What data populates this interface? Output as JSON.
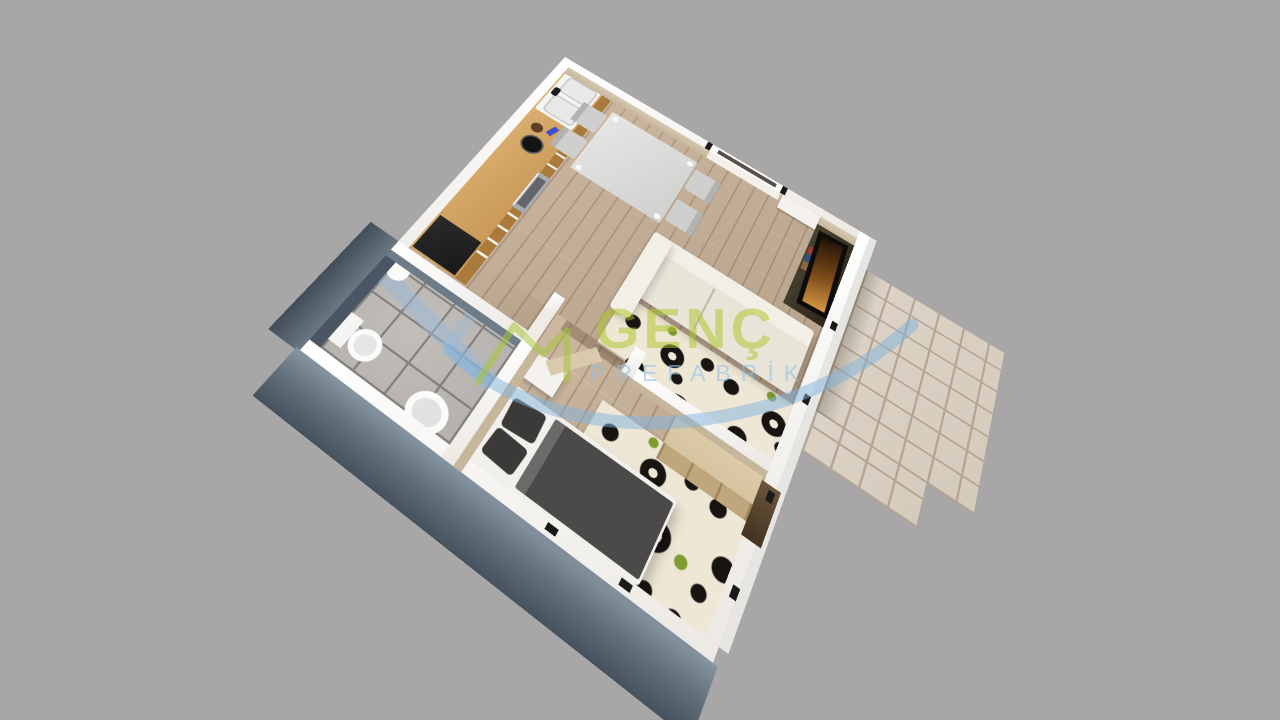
{
  "scene": {
    "description": "3D isometric top-down rendering of a one-bedroom prefabricated house floor plan on a gray backdrop",
    "view": "aerial cutaway with white wall tops"
  },
  "watermark": {
    "brand": "GENÇ",
    "subtitle": "PREFABRİK",
    "logo": "house-roof-icon with blue swoosh"
  },
  "rooms": [
    {
      "name": "kitchen-dining",
      "furniture": [
        "kitchen-counter",
        "double-sink",
        "faucet",
        "oven",
        "cooking-pot",
        "dark-appliance",
        "dining-table",
        "four-chairs"
      ]
    },
    {
      "name": "living-room",
      "furniture": [
        "cream-sofa",
        "damask-rug",
        "tv-panel",
        "media-console",
        "window"
      ]
    },
    {
      "name": "bathroom",
      "furniture": [
        "toilet",
        "round-basin",
        "glass-shower-enclosure",
        "shower-head"
      ]
    },
    {
      "name": "bedroom",
      "furniture": [
        "double-bed",
        "two-pillows",
        "dark-duvet",
        "damask-rug",
        "wardrobe",
        "nightstand"
      ]
    },
    {
      "name": "patio",
      "furniture": [
        "tiled-deck"
      ]
    }
  ],
  "colors": {
    "bg": "#a8a6a6",
    "wall": "#ece9e4",
    "wallface": "#c6b69c",
    "bathwall": "#4a5663",
    "wood": "#cdb8a1",
    "counter": "#c79756",
    "counterface": "#aa7a3c",
    "steel": "#a8aaac",
    "appliance": "#191919",
    "tabletop": "#d0d0ce",
    "chair": "#cfcfcd",
    "sofa": "#e9e4d8",
    "sofaback": "#f2efe6",
    "rugbg": "#efe7d5",
    "rugink": "#171412",
    "rugleaf": "#7f9c2e",
    "bedbase": "#f2f0ec",
    "duvet": "#4b4a48",
    "pillow": "#3b3a38",
    "wardrobe": "#d3c09c",
    "wardrobeface": "#bfa67d",
    "bathtile": "#b4b0ad",
    "bathgrout": "#83807e",
    "patiotile": "#d5cbbd",
    "patiogrout": "#b3a593",
    "tvdark": "#0e0c0a",
    "brandgreen": "#a9c43a",
    "brandblue": "#7fb3dd"
  }
}
